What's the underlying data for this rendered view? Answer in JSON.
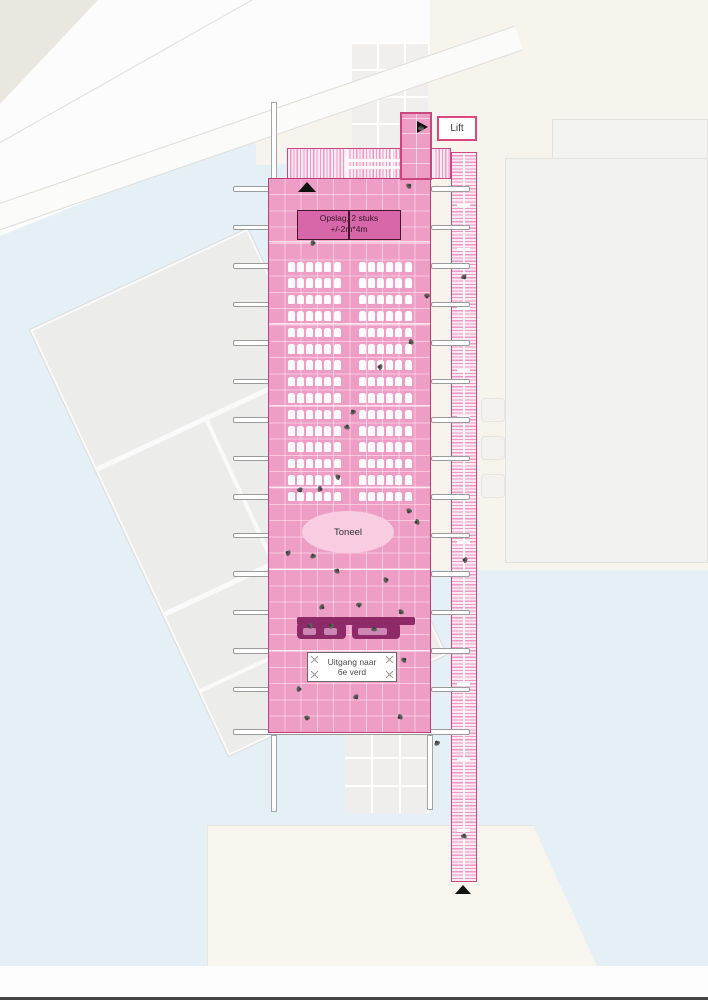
{
  "labels": {
    "lift": "Lift",
    "opslag_line1": "Opslag, 2 stuks",
    "opslag_line2": "+/-2m*4m",
    "toneel": "Toneel",
    "uitgang_line1": "Uitgang naar",
    "uitgang_line2": "6e verd"
  },
  "colors": {
    "floor": "#ee9dc5",
    "floor_border": "#c13d78",
    "hatch_line": "#eb9bc3",
    "band_border": "#c8487e",
    "dark_box": "#d767a8",
    "dark_box_border": "#47132f",
    "bar": "#8e2a67",
    "bar_slot": "#cd85b4",
    "stage": "#f8cce1",
    "water": "#e4eff6",
    "beige": "#f7f4ee",
    "person": "#5f5f5f"
  },
  "seating": {
    "rows": 15,
    "seats_per_block": 6,
    "blocks": 2,
    "row_start_y": 262,
    "row_step": 16.4,
    "left_block_x": 287.5,
    "right_block_x": 358.5,
    "seat_pitch": 9.2
  },
  "beams": {
    "start_y": 186,
    "step": 38.5,
    "count": 14,
    "left_x": 233,
    "left_w": 39,
    "right_x": 431,
    "right_w": 39
  },
  "strip": {
    "ticks_y": [
      203,
      247,
      306,
      368,
      415,
      456,
      497,
      540,
      610,
      682,
      757,
      828
    ],
    "dividers_y": [
      487,
      620,
      700,
      775,
      845
    ]
  },
  "faint_squares_y": [
    398,
    436,
    474
  ],
  "figures": [
    [
      421,
      128
    ],
    [
      409,
      186
    ],
    [
      313,
      243
    ],
    [
      464,
      277
    ],
    [
      427,
      296
    ],
    [
      411,
      342
    ],
    [
      380,
      367
    ],
    [
      353,
      412
    ],
    [
      347,
      427
    ],
    [
      338,
      477
    ],
    [
      320,
      489
    ],
    [
      300,
      490
    ],
    [
      409,
      511
    ],
    [
      417,
      522
    ],
    [
      288,
      553
    ],
    [
      313,
      556
    ],
    [
      337,
      571
    ],
    [
      386,
      580
    ],
    [
      322,
      607
    ],
    [
      359,
      605
    ],
    [
      401,
      612
    ],
    [
      310,
      626
    ],
    [
      331,
      626
    ],
    [
      374,
      629
    ],
    [
      404,
      660
    ],
    [
      299,
      689
    ],
    [
      356,
      697
    ],
    [
      307,
      718
    ],
    [
      400,
      717
    ],
    [
      465,
      560
    ],
    [
      437,
      743
    ],
    [
      464,
      836
    ]
  ]
}
